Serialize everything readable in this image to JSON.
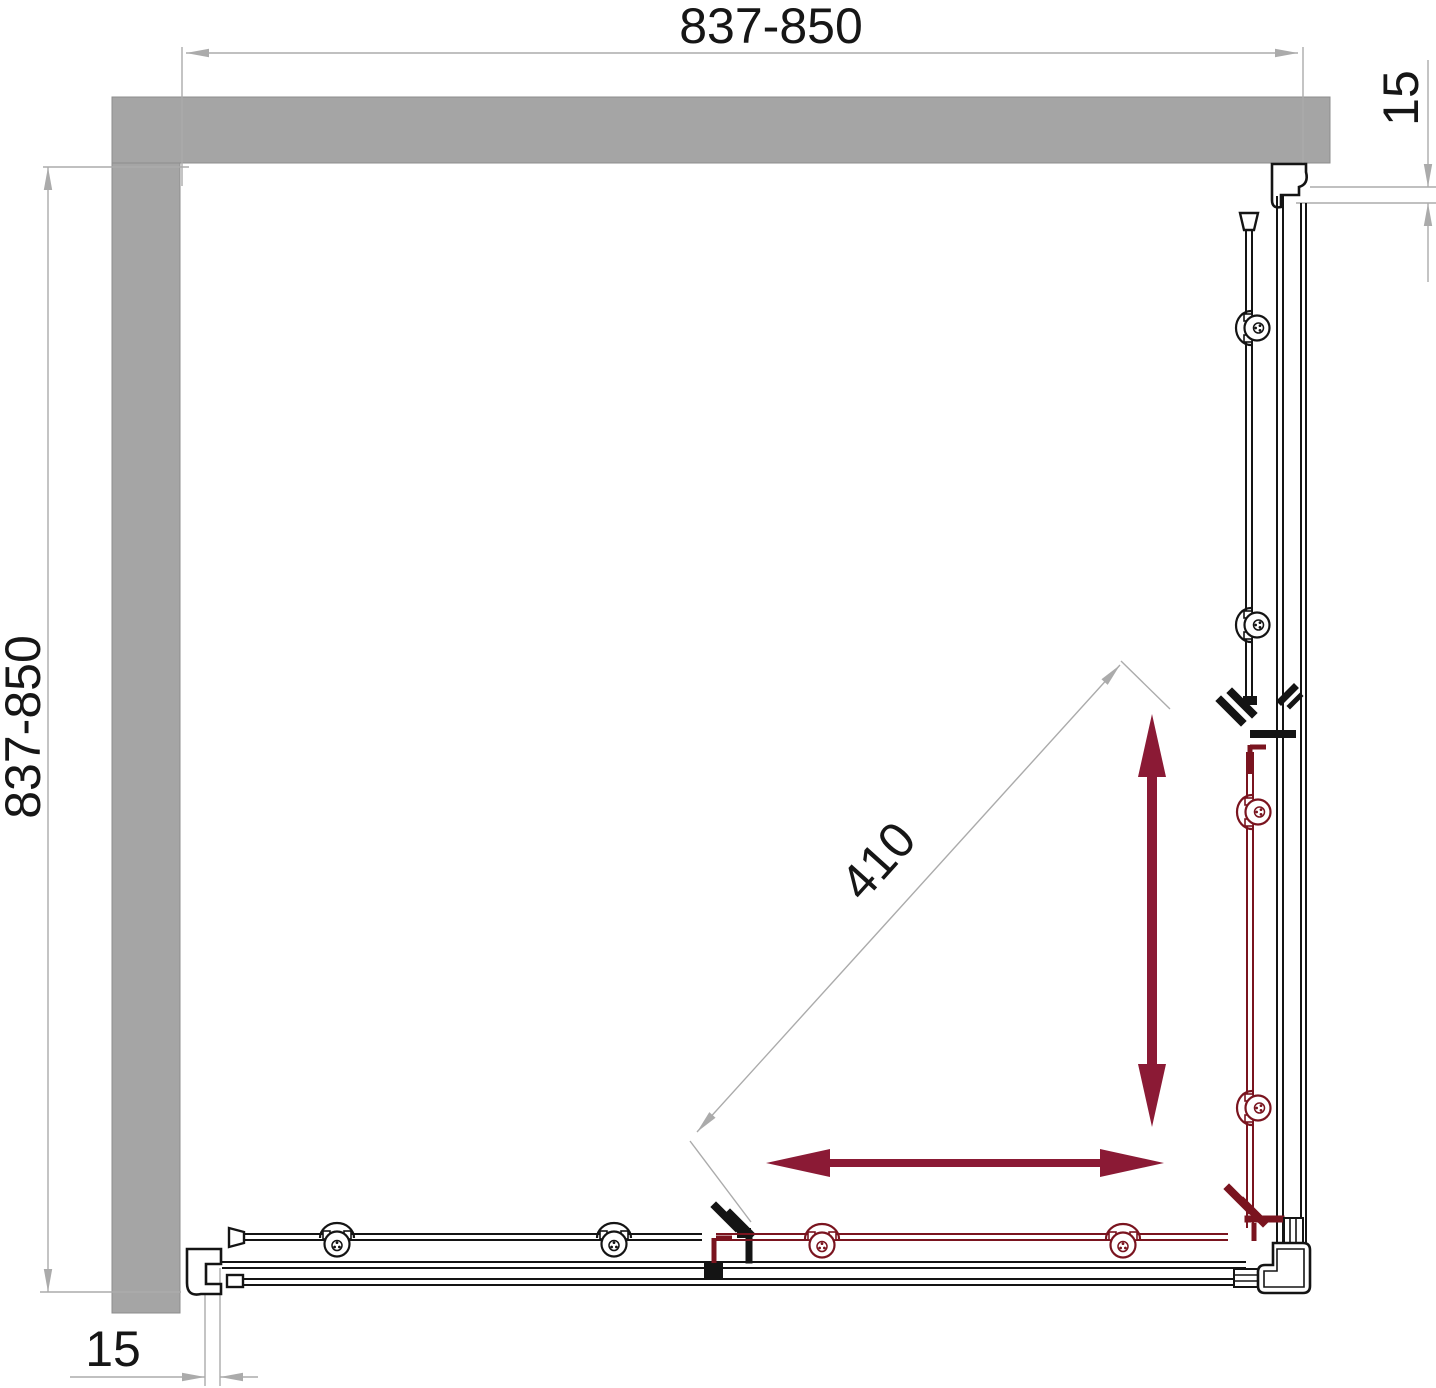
{
  "diagram": {
    "title": "shower-enclosure-corner-entry-top-view",
    "dimensions": {
      "top_width": "837-850",
      "left_depth": "837-850",
      "right_gap": "15",
      "bottom_gap": "15",
      "diagonal_opening": "410"
    },
    "icons": {
      "slide_arrow_vertical": "double-headed-arrow",
      "slide_arrow_horizontal": "double-headed-arrow"
    },
    "colors": {
      "wall_fill": "#a5a5a5",
      "dim_gray": "#ababab",
      "line_black": "#141414",
      "door_red": "#7a141f",
      "arrow_red": "#8b1a35"
    }
  }
}
